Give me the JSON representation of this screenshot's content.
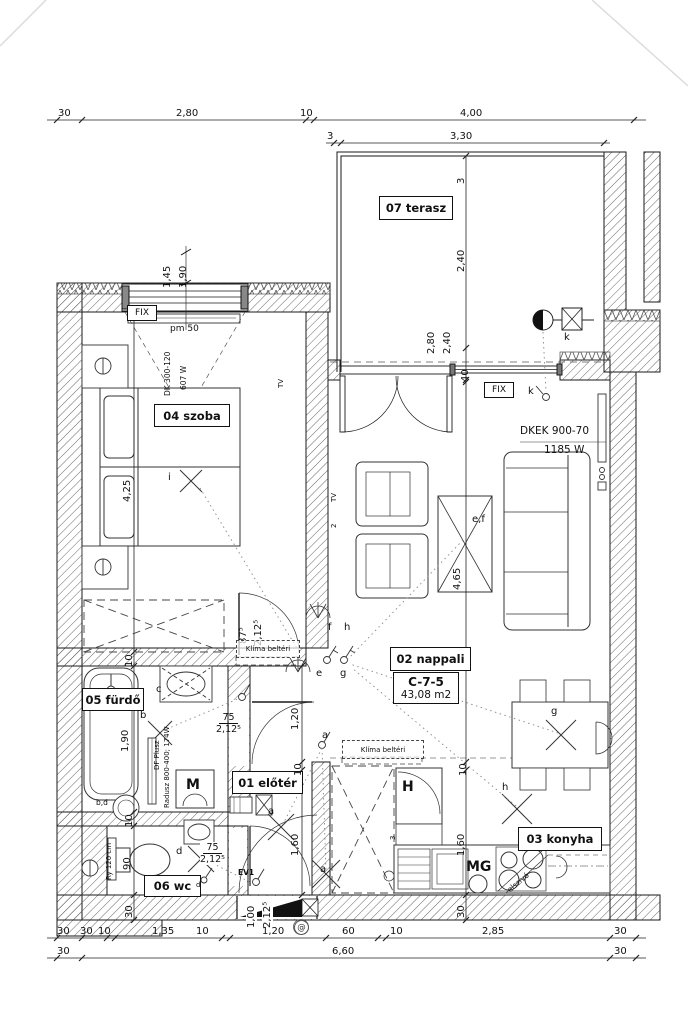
{
  "rooms": {
    "terasz": "07 terasz",
    "szoba": "04 szoba",
    "furdo": "05 fürdő",
    "eloter": "01 előtér",
    "wc": "06 wc",
    "nappali": "02 nappali",
    "konyha": "03 konyha",
    "unit": "C-7-5",
    "area": "43,08 m2"
  },
  "dims": {
    "d30": "30",
    "d10": "10",
    "d3": "3",
    "d40": "40",
    "d60": "60",
    "d90": "90",
    "d280": "2,80",
    "d400": "4,00",
    "d330": "3,30",
    "d240": "2,40",
    "d145": "1,45",
    "d190": "1,90",
    "d425": "4,25",
    "d465": "4,65",
    "d120": "1,20",
    "d160": "1,60",
    "d135": "1,35",
    "d285": "2,85",
    "d660": "6,60",
    "d100": "1,00",
    "d75": "75",
    "d875": "87⁵",
    "d2125": "2,12⁵",
    "pm50": "pm  50"
  },
  "equipment": {
    "fix": "FIX",
    "dk": "DK 300-120",
    "dk_w": "607 W",
    "dkek": "DKEK 900-70",
    "dkek_w": "1185 W",
    "df": "DF Plusz",
    "radusz": "Radusz 800-400; 174W",
    "ry": "Ry 120 cm",
    "klima": "Klíma beltéri",
    "ev1": "EV1",
    "m": "M",
    "mg": "MG",
    "h": "H",
    "tv": "TV",
    "elszivo": "elszívó",
    "at": "@",
    "s2": "2",
    "s3": "3"
  },
  "markers": {
    "a": "a",
    "b": "b",
    "bd": "b,d",
    "c": "c",
    "d": "d",
    "e": "e",
    "ef": "e,f",
    "f": "f",
    "g": "g",
    "h": "h",
    "i": "i",
    "k": "k"
  }
}
